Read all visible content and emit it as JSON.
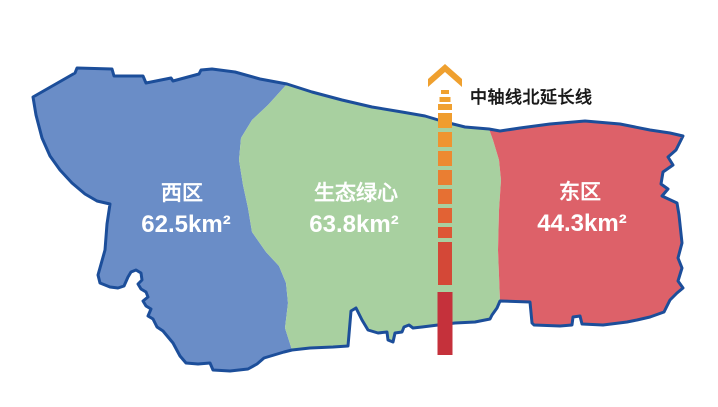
{
  "map": {
    "background": "#ffffff",
    "outline_color": "#1c4e9a",
    "regions": [
      {
        "id": "west",
        "name": "西区",
        "area": "62.5km²",
        "fill": "#6a8dc7",
        "text_color": "#ffffff"
      },
      {
        "id": "green-heart",
        "name": "生态绿心",
        "area": "63.8km²",
        "fill": "#a8d0a0",
        "text_color": "#ffffff"
      },
      {
        "id": "east",
        "name": "东区",
        "area": "44.3km²",
        "fill": "#dd6169",
        "text_color": "#ffffff"
      }
    ]
  },
  "axis": {
    "label": "中轴线北延长线",
    "label_color": "#1a1a1a",
    "x": 445,
    "arrow_color": "#efa02f",
    "dashes": [
      {
        "y": 90,
        "h": 4,
        "w": 8,
        "color": "#f0a12f"
      },
      {
        "y": 97,
        "h": 5,
        "w": 11,
        "color": "#f0a12f"
      },
      {
        "y": 104,
        "h": 6,
        "w": 14,
        "color": "#f0a030"
      },
      {
        "y": 113,
        "h": 15,
        "w": 14,
        "color": "#f09d2e"
      },
      {
        "y": 132,
        "h": 15,
        "w": 14,
        "color": "#ef9430"
      },
      {
        "y": 151,
        "h": 15,
        "w": 14,
        "color": "#ed8a31"
      },
      {
        "y": 170,
        "h": 15,
        "w": 14,
        "color": "#ea7e32"
      },
      {
        "y": 189,
        "h": 15,
        "w": 14,
        "color": "#e67033"
      },
      {
        "y": 208,
        "h": 15,
        "w": 14,
        "color": "#e26234"
      },
      {
        "y": 227,
        "h": 11,
        "w": 14,
        "color": "#dd5635"
      },
      {
        "y": 242,
        "h": 43,
        "w": 14,
        "color": "#d44837"
      },
      {
        "y": 292,
        "h": 63,
        "w": 15,
        "color": "#c5313b"
      }
    ]
  }
}
